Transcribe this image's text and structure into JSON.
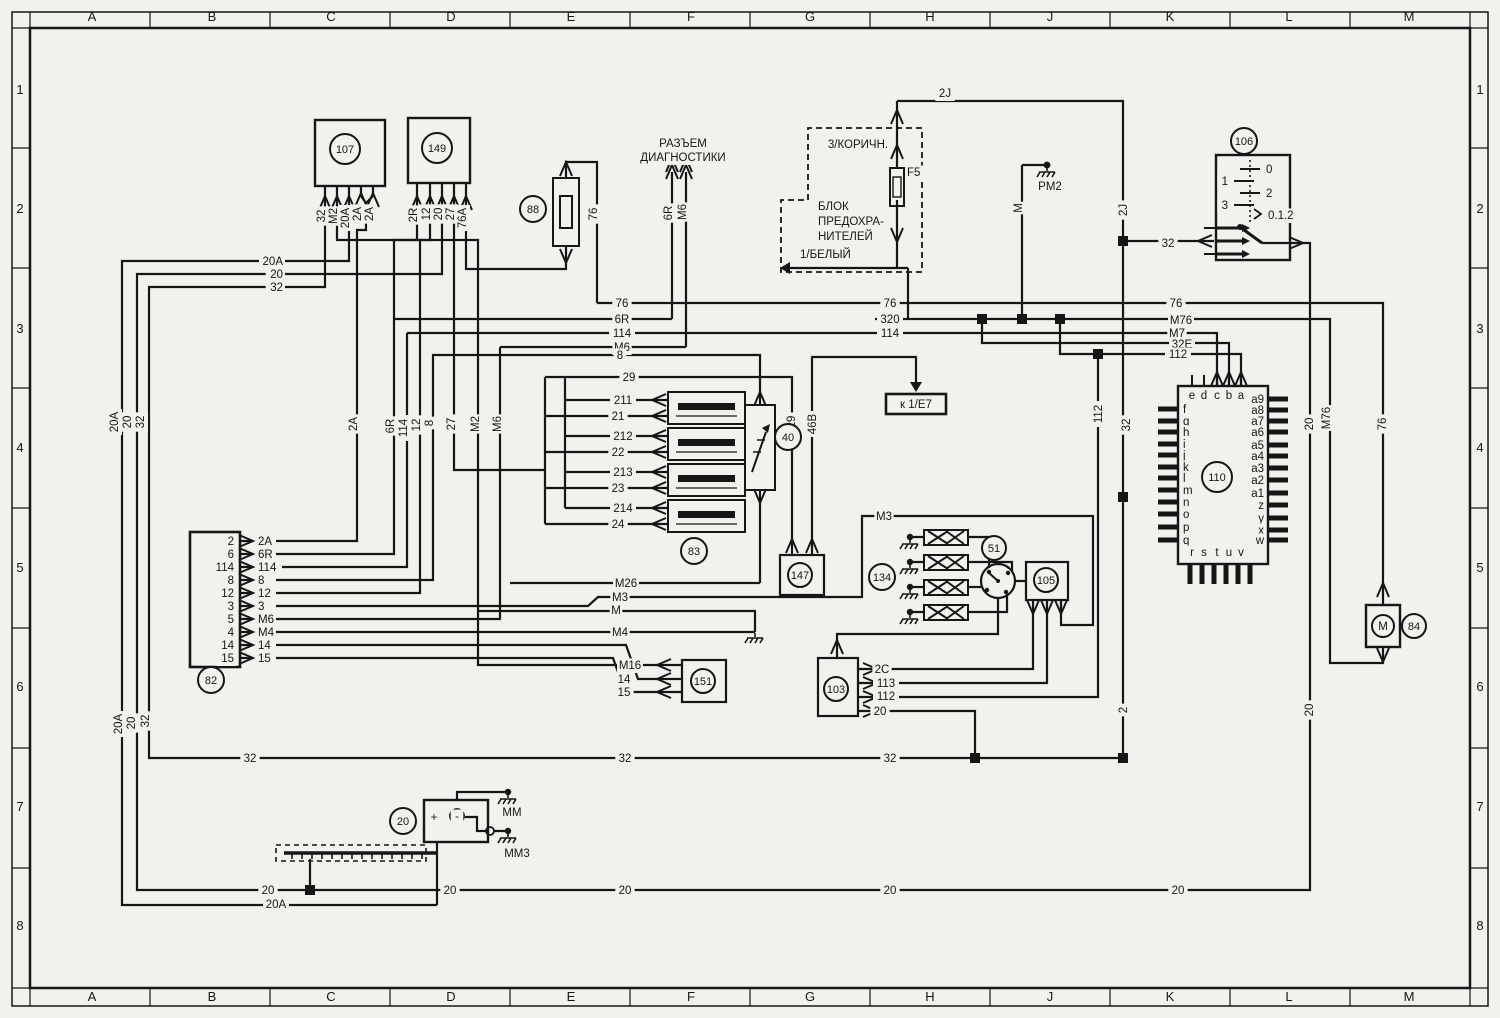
{
  "colors": {
    "bg": "#f2f1ee",
    "ink": "#161616"
  },
  "grid": {
    "cols": [
      "A",
      "B",
      "C",
      "D",
      "E",
      "F",
      "G",
      "H",
      "J",
      "K",
      "L",
      "M"
    ],
    "rows": [
      "1",
      "2",
      "3",
      "4",
      "5",
      "6",
      "7",
      "8"
    ]
  },
  "components": [
    {
      "id": "107",
      "x": 345,
      "y": 149,
      "r": 15
    },
    {
      "id": "149",
      "x": 437,
      "y": 148,
      "r": 15
    },
    {
      "id": "88",
      "x": 533,
      "y": 209,
      "r": 13
    },
    {
      "id": "106",
      "x": 1244,
      "y": 141,
      "r": 13
    },
    {
      "id": "40",
      "x": 788,
      "y": 437,
      "r": 13
    },
    {
      "id": "83",
      "x": 694,
      "y": 551,
      "r": 13
    },
    {
      "id": "147",
      "x": 800,
      "y": 575,
      "r": 12
    },
    {
      "id": "134",
      "x": 882,
      "y": 577,
      "r": 13
    },
    {
      "id": "51",
      "x": 994,
      "y": 548,
      "r": 12
    },
    {
      "id": "105",
      "x": 1046,
      "y": 580,
      "r": 12
    },
    {
      "id": "110",
      "x": 1217,
      "y": 477,
      "r": 15
    },
    {
      "id": "103",
      "x": 836,
      "y": 689,
      "r": 12
    },
    {
      "id": "151",
      "x": 703,
      "y": 681,
      "r": 12
    },
    {
      "id": "84",
      "x": 1414,
      "y": 626,
      "r": 12
    },
    {
      "id": "20",
      "x": 403,
      "y": 821,
      "r": 13
    },
    {
      "id": "82",
      "x": 211,
      "y": 680,
      "r": 13
    }
  ],
  "labels": [
    {
      "t": "32",
      "x": 325,
      "y": 216,
      "r": 1
    },
    {
      "t": "M2",
      "x": 337,
      "y": 216,
      "r": 1
    },
    {
      "t": "20A",
      "x": 349,
      "y": 218,
      "r": 1
    },
    {
      "t": "2A",
      "x": 361,
      "y": 214,
      "r": 1
    },
    {
      "t": "2A",
      "x": 373,
      "y": 214,
      "r": 1
    },
    {
      "t": "2R",
      "x": 417,
      "y": 215,
      "r": 1
    },
    {
      "t": "12",
      "x": 430,
      "y": 214,
      "r": 1
    },
    {
      "t": "20",
      "x": 442,
      "y": 214,
      "r": 1
    },
    {
      "t": "27",
      "x": 454,
      "y": 214,
      "r": 1
    },
    {
      "t": "76A",
      "x": 466,
      "y": 218,
      "r": 1
    },
    {
      "t": "76",
      "x": 597,
      "y": 214,
      "r": 1
    },
    {
      "t": "6R",
      "x": 672,
      "y": 213,
      "r": 1
    },
    {
      "t": "M6",
      "x": 686,
      "y": 212,
      "r": 1
    },
    {
      "t": "M",
      "x": 1022,
      "y": 208,
      "r": 1
    },
    {
      "t": "2J",
      "x": 1127,
      "y": 210,
      "r": 1
    },
    {
      "t": "20A",
      "x": 118,
      "y": 422,
      "r": 1
    },
    {
      "t": "20",
      "x": 131,
      "y": 422,
      "r": 1
    },
    {
      "t": "32",
      "x": 144,
      "y": 422,
      "r": 1
    },
    {
      "t": "2A",
      "x": 357,
      "y": 424,
      "r": 1
    },
    {
      "t": "6R",
      "x": 394,
      "y": 426,
      "r": 1
    },
    {
      "t": "114",
      "x": 407,
      "y": 428,
      "r": 1
    },
    {
      "t": "12",
      "x": 420,
      "y": 425,
      "r": 1
    },
    {
      "t": "8",
      "x": 433,
      "y": 423,
      "r": 1
    },
    {
      "t": "27",
      "x": 455,
      "y": 424,
      "r": 1
    },
    {
      "t": "M2",
      "x": 479,
      "y": 424,
      "r": 1
    },
    {
      "t": "M6",
      "x": 501,
      "y": 424,
      "r": 1
    },
    {
      "t": "29",
      "x": 795,
      "y": 422,
      "r": 1
    },
    {
      "t": "46B",
      "x": 816,
      "y": 424,
      "r": 1
    },
    {
      "t": "112",
      "x": 1102,
      "y": 414,
      "r": 1
    },
    {
      "t": "32",
      "x": 1130,
      "y": 425,
      "r": 1
    },
    {
      "t": "20",
      "x": 1313,
      "y": 424,
      "r": 1
    },
    {
      "t": "M76",
      "x": 1330,
      "y": 418,
      "r": 1
    },
    {
      "t": "76",
      "x": 1386,
      "y": 424,
      "r": 1
    },
    {
      "t": "2",
      "x": 1127,
      "y": 710,
      "r": 1
    },
    {
      "t": "20",
      "x": 1313,
      "y": 710,
      "r": 1
    },
    {
      "t": "20A",
      "x": 122,
      "y": 724,
      "r": 1
    },
    {
      "t": "20",
      "x": 135,
      "y": 723,
      "r": 1
    },
    {
      "t": "32",
      "x": 149,
      "y": 721,
      "r": 1
    },
    {
      "t": "2J",
      "x": 945,
      "y": 97
    },
    {
      "t": "32",
      "x": 1168,
      "y": 247
    },
    {
      "t": "3/КОРИЧН.",
      "x": 858,
      "y": 148
    },
    {
      "t": "F5",
      "x": 907,
      "y": 176,
      "a": "start"
    },
    {
      "t": "БЛОК",
      "x": 818,
      "y": 210,
      "a": "start"
    },
    {
      "t": "ПРЕДОХРА-",
      "x": 818,
      "y": 225,
      "a": "start"
    },
    {
      "t": "НИТЕЛЕЙ",
      "x": 818,
      "y": 240,
      "a": "start"
    },
    {
      "t": "1/БЕЛЫЙ",
      "x": 800,
      "y": 258,
      "a": "start"
    },
    {
      "t": "РАЗЪЕМ",
      "x": 683,
      "y": 147
    },
    {
      "t": "ДИАГНОСТИКИ",
      "x": 683,
      "y": 161
    },
    {
      "t": "PM2",
      "x": 1050,
      "y": 190
    },
    {
      "t": "0",
      "x": 1266,
      "y": 173,
      "a": "start"
    },
    {
      "t": "1",
      "x": 1228,
      "y": 185,
      "a": "end"
    },
    {
      "t": "2",
      "x": 1266,
      "y": 197,
      "a": "start"
    },
    {
      "t": "3",
      "x": 1228,
      "y": 209,
      "a": "end"
    },
    {
      "t": "0.1.2",
      "x": 1268,
      "y": 219,
      "a": "start"
    },
    {
      "t": "20A",
      "x": 283,
      "y": 265,
      "a": "end"
    },
    {
      "t": "20",
      "x": 283,
      "y": 278,
      "a": "end"
    },
    {
      "t": "32",
      "x": 283,
      "y": 291,
      "a": "end"
    },
    {
      "t": "76",
      "x": 622,
      "y": 307
    },
    {
      "t": "6R",
      "x": 622,
      "y": 323
    },
    {
      "t": "114",
      "x": 622,
      "y": 337
    },
    {
      "t": "M6",
      "x": 622,
      "y": 351
    },
    {
      "t": "8",
      "x": 620,
      "y": 359
    },
    {
      "t": "29",
      "x": 629,
      "y": 381
    },
    {
      "t": "76",
      "x": 890,
      "y": 307
    },
    {
      "t": "320",
      "x": 890,
      "y": 323
    },
    {
      "t": "114",
      "x": 890,
      "y": 337
    },
    {
      "t": "76",
      "x": 1176,
      "y": 307
    },
    {
      "t": "M76",
      "x": 1181,
      "y": 324
    },
    {
      "t": "M7",
      "x": 1177,
      "y": 337
    },
    {
      "t": "32E",
      "x": 1182,
      "y": 348
    },
    {
      "t": "112",
      "x": 1178,
      "y": 358
    },
    {
      "t": "211",
      "x": 623,
      "y": 404
    },
    {
      "t": "21",
      "x": 618,
      "y": 420
    },
    {
      "t": "212",
      "x": 623,
      "y": 440
    },
    {
      "t": "22",
      "x": 618,
      "y": 456
    },
    {
      "t": "213",
      "x": 623,
      "y": 476
    },
    {
      "t": "23",
      "x": 618,
      "y": 492
    },
    {
      "t": "214",
      "x": 623,
      "y": 512
    },
    {
      "t": "24",
      "x": 618,
      "y": 528
    },
    {
      "t": "к 1/Е7",
      "x": 916,
      "y": 408
    },
    {
      "t": "M26",
      "x": 626,
      "y": 587
    },
    {
      "t": "M3",
      "x": 620,
      "y": 601
    },
    {
      "t": "M",
      "x": 616,
      "y": 614
    },
    {
      "t": "M4",
      "x": 620,
      "y": 636
    },
    {
      "t": "M3",
      "x": 884,
      "y": 520
    },
    {
      "t": "M16",
      "x": 630,
      "y": 669
    },
    {
      "t": "14",
      "x": 624,
      "y": 683
    },
    {
      "t": "15",
      "x": 624,
      "y": 696
    },
    {
      "t": "2C",
      "x": 882,
      "y": 673
    },
    {
      "t": "113",
      "x": 886,
      "y": 687
    },
    {
      "t": "112",
      "x": 886,
      "y": 700
    },
    {
      "t": "20",
      "x": 880,
      "y": 715
    },
    {
      "t": "32",
      "x": 250,
      "y": 762
    },
    {
      "t": "32",
      "x": 625,
      "y": 762
    },
    {
      "t": "32",
      "x": 890,
      "y": 762
    },
    {
      "t": "20",
      "x": 268,
      "y": 894
    },
    {
      "t": "20A",
      "x": 276,
      "y": 908
    },
    {
      "t": "20",
      "x": 450,
      "y": 894
    },
    {
      "t": "20",
      "x": 625,
      "y": 894
    },
    {
      "t": "20",
      "x": 890,
      "y": 894
    },
    {
      "t": "20",
      "x": 1178,
      "y": 894
    },
    {
      "t": "MM",
      "x": 512,
      "y": 816
    },
    {
      "t": "MM3",
      "x": 517,
      "y": 857
    },
    {
      "t": "+",
      "x": 434,
      "y": 821
    },
    {
      "t": "-",
      "x": 457,
      "y": 820
    },
    {
      "t": "M",
      "x": 1383,
      "y": 630
    },
    {
      "t": "2",
      "x": 234,
      "y": 545,
      "a": "end"
    },
    {
      "t": "6",
      "x": 234,
      "y": 558,
      "a": "end"
    },
    {
      "t": "114",
      "x": 234,
      "y": 571,
      "a": "end"
    },
    {
      "t": "8",
      "x": 234,
      "y": 584,
      "a": "end"
    },
    {
      "t": "12",
      "x": 234,
      "y": 597,
      "a": "end"
    },
    {
      "t": "3",
      "x": 234,
      "y": 610,
      "a": "end"
    },
    {
      "t": "5",
      "x": 234,
      "y": 623,
      "a": "end"
    },
    {
      "t": "4",
      "x": 234,
      "y": 636,
      "a": "end"
    },
    {
      "t": "14",
      "x": 234,
      "y": 649,
      "a": "end"
    },
    {
      "t": "15",
      "x": 234,
      "y": 662,
      "a": "end"
    },
    {
      "t": "2A",
      "x": 258,
      "y": 545,
      "a": "start"
    },
    {
      "t": "6R",
      "x": 258,
      "y": 558,
      "a": "start"
    },
    {
      "t": "114",
      "x": 258,
      "y": 571,
      "a": "start"
    },
    {
      "t": "8",
      "x": 258,
      "y": 584,
      "a": "start"
    },
    {
      "t": "12",
      "x": 258,
      "y": 597,
      "a": "start"
    },
    {
      "t": "3",
      "x": 258,
      "y": 610,
      "a": "start"
    },
    {
      "t": "M6",
      "x": 258,
      "y": 623,
      "a": "start"
    },
    {
      "t": "M4",
      "x": 258,
      "y": 636,
      "a": "start"
    },
    {
      "t": "14",
      "x": 258,
      "y": 649,
      "a": "start"
    },
    {
      "t": "15",
      "x": 258,
      "y": 662,
      "a": "start"
    },
    {
      "t": "e",
      "x": 1192,
      "y": 399
    },
    {
      "t": "d",
      "x": 1204,
      "y": 399
    },
    {
      "t": "c",
      "x": 1217,
      "y": 399
    },
    {
      "t": "b",
      "x": 1229,
      "y": 399
    },
    {
      "t": "a",
      "x": 1241,
      "y": 399
    },
    {
      "t": "f",
      "x": 1183,
      "y": 413,
      "a": "start"
    },
    {
      "t": "g",
      "x": 1183,
      "y": 425,
      "a": "start"
    },
    {
      "t": "h",
      "x": 1183,
      "y": 436,
      "a": "start"
    },
    {
      "t": "i",
      "x": 1183,
      "y": 448,
      "a": "start"
    },
    {
      "t": "j",
      "x": 1183,
      "y": 459,
      "a": "start"
    },
    {
      "t": "k",
      "x": 1183,
      "y": 471,
      "a": "start"
    },
    {
      "t": "l",
      "x": 1183,
      "y": 482,
      "a": "start"
    },
    {
      "t": "m",
      "x": 1183,
      "y": 494,
      "a": "start"
    },
    {
      "t": "n",
      "x": 1183,
      "y": 506,
      "a": "start"
    },
    {
      "t": "o",
      "x": 1183,
      "y": 518,
      "a": "start"
    },
    {
      "t": "p",
      "x": 1183,
      "y": 531,
      "a": "start"
    },
    {
      "t": "q",
      "x": 1183,
      "y": 544,
      "a": "start"
    },
    {
      "t": "a9",
      "x": 1264,
      "y": 403,
      "a": "end"
    },
    {
      "t": "a8",
      "x": 1264,
      "y": 414,
      "a": "end"
    },
    {
      "t": "a7",
      "x": 1264,
      "y": 425,
      "a": "end"
    },
    {
      "t": "a6",
      "x": 1264,
      "y": 436,
      "a": "end"
    },
    {
      "t": "a5",
      "x": 1264,
      "y": 449,
      "a": "end"
    },
    {
      "t": "a4",
      "x": 1264,
      "y": 460,
      "a": "end"
    },
    {
      "t": "a3",
      "x": 1264,
      "y": 472,
      "a": "end"
    },
    {
      "t": "a2",
      "x": 1264,
      "y": 484,
      "a": "end"
    },
    {
      "t": "a1",
      "x": 1264,
      "y": 497,
      "a": "end"
    },
    {
      "t": "z",
      "x": 1264,
      "y": 509,
      "a": "end"
    },
    {
      "t": "y",
      "x": 1264,
      "y": 522,
      "a": "end"
    },
    {
      "t": "x",
      "x": 1264,
      "y": 534,
      "a": "end"
    },
    {
      "t": "w",
      "x": 1264,
      "y": 544,
      "a": "end"
    },
    {
      "t": "r",
      "x": 1192,
      "y": 556
    },
    {
      "t": "s",
      "x": 1204,
      "y": 556
    },
    {
      "t": "t",
      "x": 1217,
      "y": 556
    },
    {
      "t": "u",
      "x": 1229,
      "y": 556
    },
    {
      "t": "v",
      "x": 1241,
      "y": 556
    }
  ]
}
